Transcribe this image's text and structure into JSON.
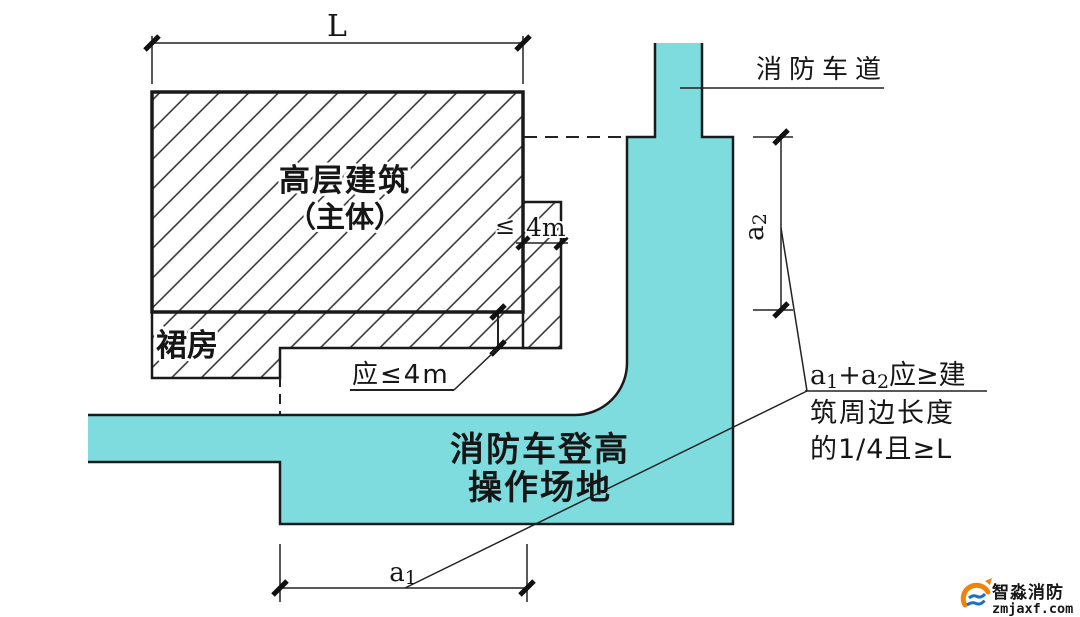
{
  "labels": {
    "building_l1": "高层建筑",
    "building_l2": "（主体）",
    "podium": "裙房",
    "fire_lane": "消防车道",
    "site_l1": "消防车登高",
    "site_l2": "操作场地"
  },
  "dims": {
    "L": "L",
    "a1_base": "a",
    "a1_sub": "1",
    "a2_base": "a",
    "a2_sub": "2",
    "lte": "≤",
    "four_m": "4m",
    "ying_lte_4m": "应≤4m"
  },
  "annotation": {
    "p1": "a",
    "s1": "1",
    "p2": "+a",
    "s2": "2",
    "p3": "应≥建",
    "line2": "筑周边长度",
    "line3": "的1/4且≥L"
  },
  "logo": {
    "brand": "智淼消防",
    "site": "zmjaxf.com"
  },
  "colors": {
    "site_fill": "#7edcde",
    "ink": "#1a1a1a",
    "brand_orange": "#f0830a",
    "brand_blue": "#1d6fc0"
  }
}
